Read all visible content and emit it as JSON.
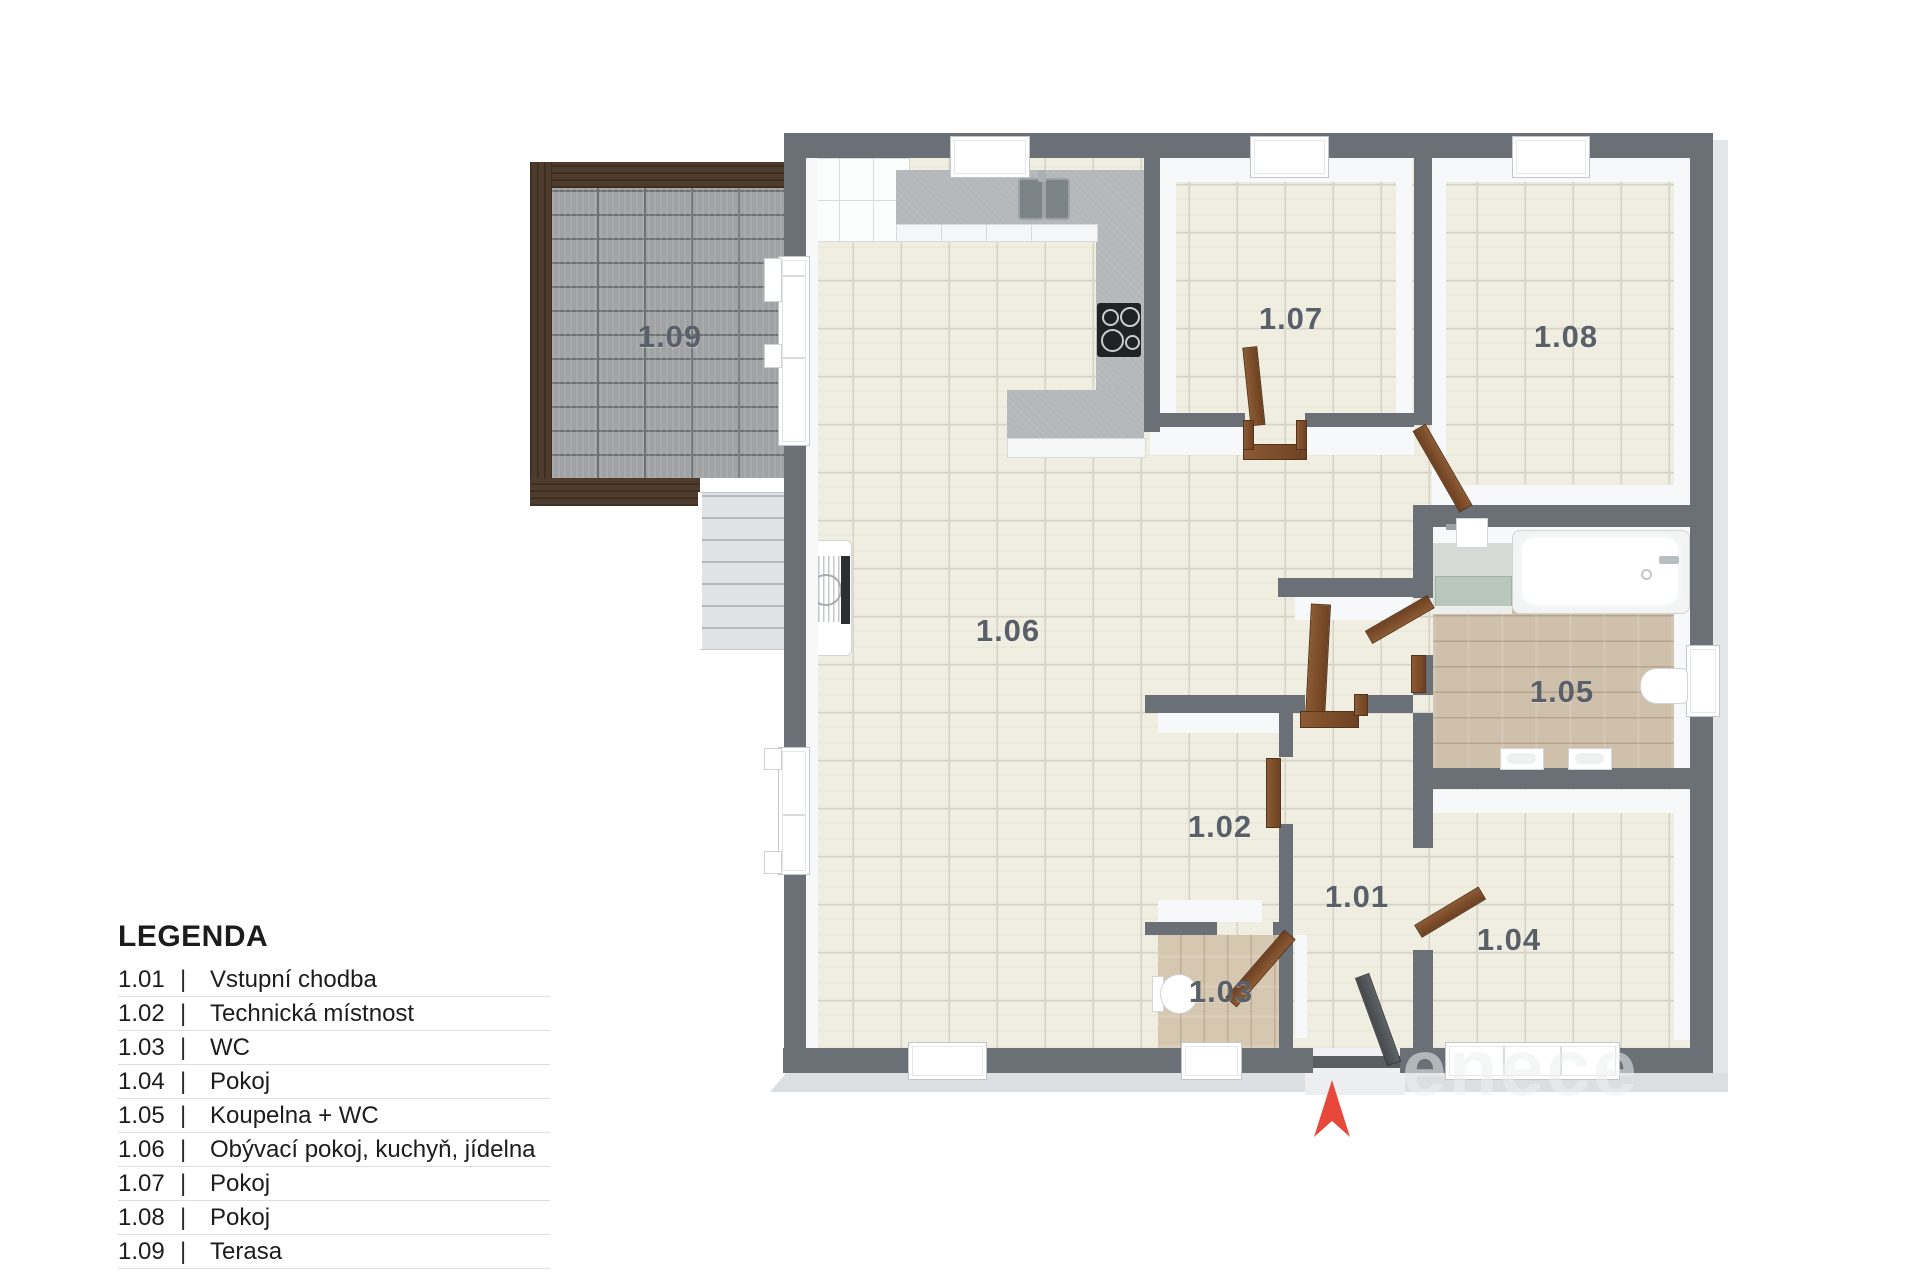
{
  "legend": {
    "title": "LEGENDA",
    "separator": "|",
    "rows": [
      {
        "code": "1.01",
        "name": "Vstupní chodba"
      },
      {
        "code": "1.02",
        "name": "Technická místnost"
      },
      {
        "code": "1.03",
        "name": "WC"
      },
      {
        "code": "1.04",
        "name": "Pokoj"
      },
      {
        "code": "1.05",
        "name": "Koupelna + WC"
      },
      {
        "code": "1.06",
        "name": "Obývací pokoj, kuchyň, jídelna"
      },
      {
        "code": "1.07",
        "name": "Pokoj"
      },
      {
        "code": "1.08",
        "name": "Pokoj"
      },
      {
        "code": "1.09",
        "name": "Terasa"
      }
    ]
  },
  "plan": {
    "room_labels": [
      {
        "id": "1.09",
        "x": 670,
        "y": 337
      },
      {
        "id": "1.06",
        "x": 1008,
        "y": 631
      },
      {
        "id": "1.07",
        "x": 1291,
        "y": 319
      },
      {
        "id": "1.08",
        "x": 1566,
        "y": 337
      },
      {
        "id": "1.05",
        "x": 1562,
        "y": 692
      },
      {
        "id": "1.02",
        "x": 1220,
        "y": 827
      },
      {
        "id": "1.01",
        "x": 1357,
        "y": 897
      },
      {
        "id": "1.03",
        "x": 1221,
        "y": 992
      },
      {
        "id": "1.04",
        "x": 1509,
        "y": 940
      }
    ],
    "watermark": "enece",
    "colors": {
      "wall": "#6a7076",
      "label": "#59606a",
      "arrow": "#e8483b",
      "wood_door": "#7d4e28",
      "terrace_frame": "#4e3b2b"
    }
  }
}
